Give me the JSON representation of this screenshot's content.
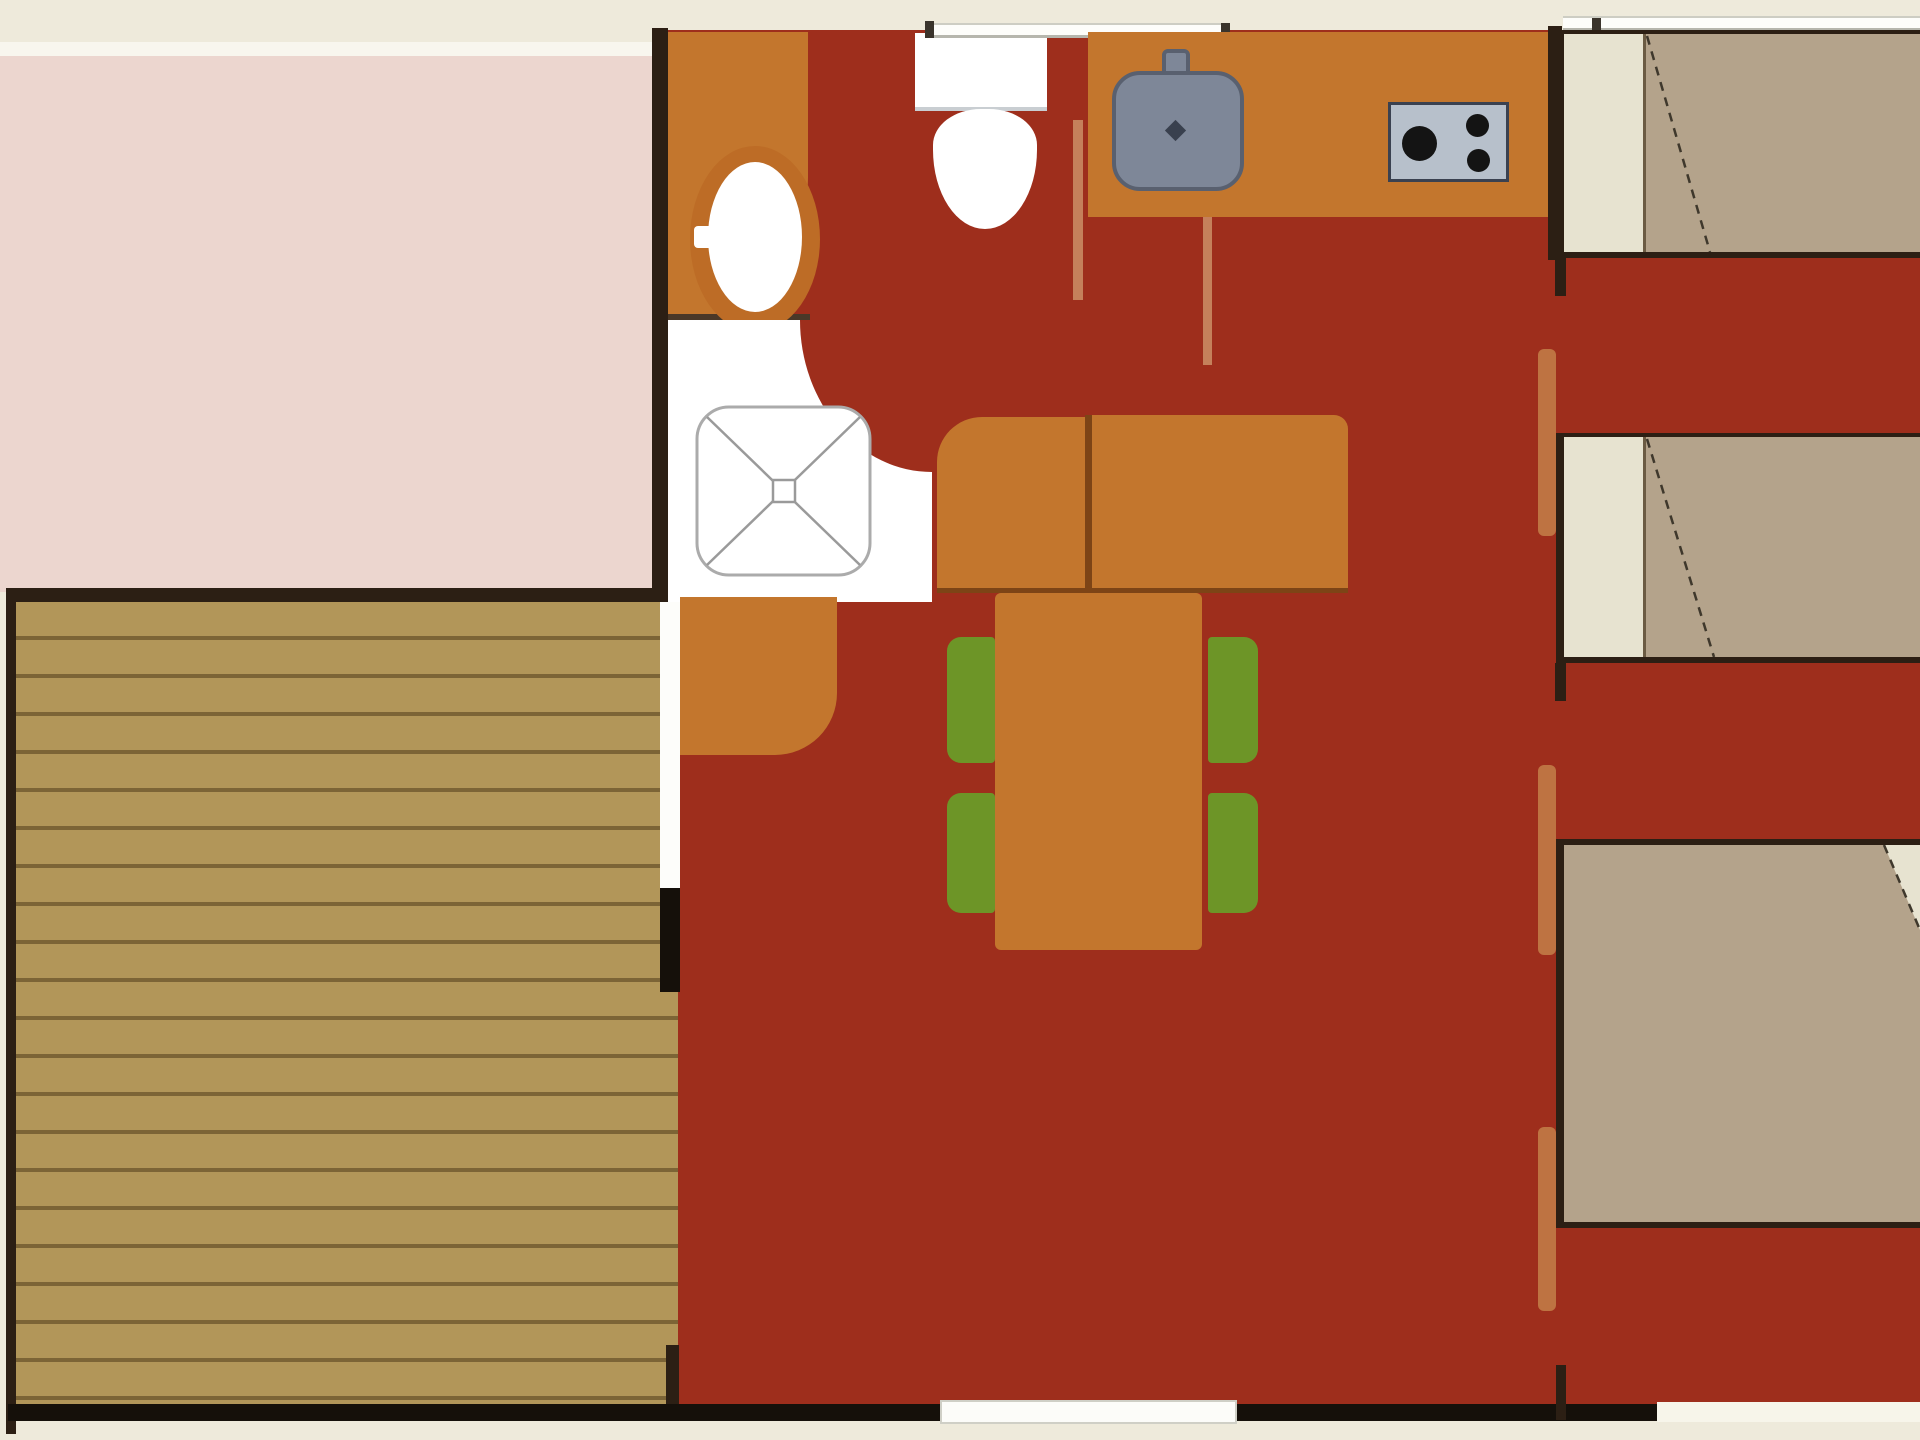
{
  "meta": {
    "kind": "floor-plan",
    "view": "top-down 2D plan of a mobile-home / chalet, no text labels rendered"
  },
  "palette": {
    "cream": "#eeeadb",
    "cream-line": "#f8f6ee",
    "pink": "#ecd6cf",
    "floor-red": "#9e2e1c",
    "furn-orange": "#c3762d",
    "furn-orange-dark": "#7d4416",
    "sink-ring": "#bd6c26",
    "wall-dark": "#2c1f14",
    "wall-black": "#15100a",
    "deck-fill": "#b29659",
    "deck-line": "#7c6436",
    "bed-tan": "#b4a38b",
    "pillow-cream": "#e7e3d0",
    "bed-line": "#4a3a2a",
    "chair-green": "#6d9527",
    "jamb-orange": "#be7342",
    "partition-salmon": "#c5805b",
    "sink-gray": "#7e8798",
    "sink-gray-border": "#59606f",
    "stove-gray": "#b7c0cb",
    "stove-border": "#3a4150",
    "burner-black": "#141414",
    "tray-border": "#ababab",
    "tray-x": "#9a9a9a"
  },
  "rooms": [
    {
      "name": "pink-room",
      "position": "top-left"
    },
    {
      "name": "wood-deck-terrace",
      "position": "bottom-left",
      "planks": "horizontal"
    },
    {
      "name": "bathroom",
      "position": "top-center-left",
      "fixtures": [
        "washbasin",
        "shower"
      ]
    },
    {
      "name": "wc",
      "position": "top-center",
      "fixtures": [
        "toilet"
      ]
    },
    {
      "name": "kitchen",
      "position": "top-right-of-center",
      "fixtures": [
        "kitchen-sink",
        "stove-2-burners"
      ]
    },
    {
      "name": "living-dining",
      "position": "center",
      "furniture": [
        "sofa-2-seats",
        "dining-table",
        "4-green-chairs",
        "cabinet"
      ]
    },
    {
      "name": "bedroom-area",
      "position": "right",
      "beds": 3,
      "doors": 3
    }
  ],
  "furniture_counts": {
    "beds": 3,
    "chairs": 4,
    "sofa_sections": 2,
    "burners": 3,
    "windows": 2,
    "door_openings": 4
  }
}
